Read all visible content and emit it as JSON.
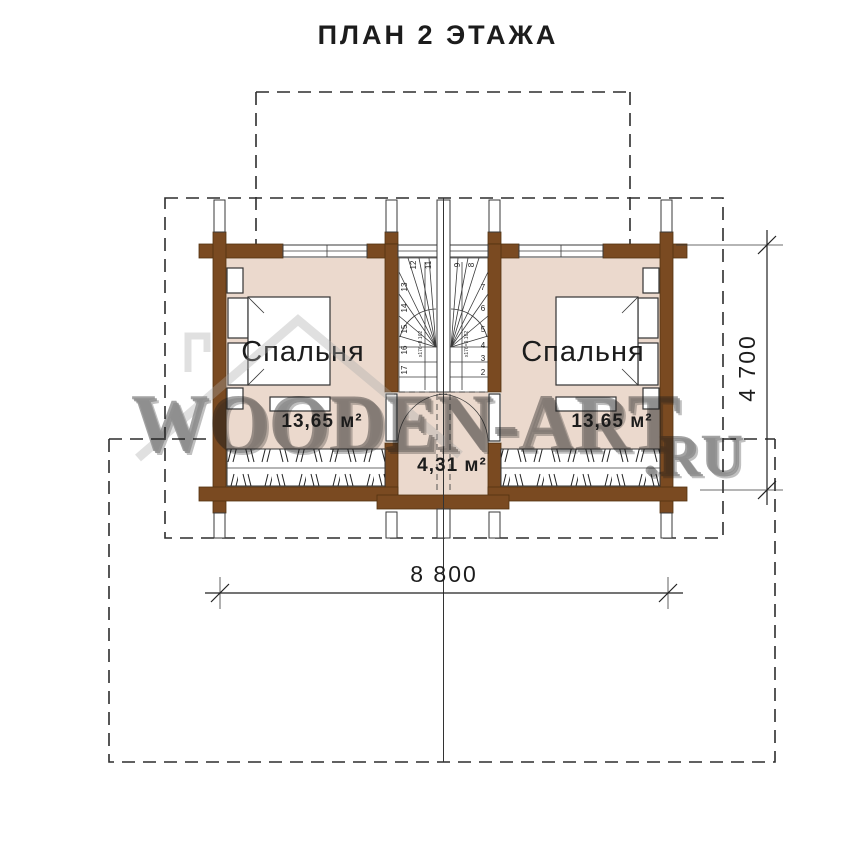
{
  "title": "ПЛАН 2 ЭТАЖА",
  "watermark": {
    "main": "WOODEN-ART",
    "suffix": ".RU"
  },
  "rooms": {
    "left_bedroom": {
      "name": "Спальня",
      "area": "13,65 м²"
    },
    "right_bedroom": {
      "name": "Спальня",
      "area": "13,65 м²"
    },
    "hall": {
      "area": "4,31 м²"
    }
  },
  "dimensions": {
    "width": "8 800",
    "depth": "4 700"
  },
  "stairs": {
    "note": "x176=9.162",
    "left": {
      "top_numbers": [
        "12",
        "11"
      ],
      "side_numbers": [
        "13",
        "14",
        "15",
        "16",
        "17"
      ]
    },
    "right": {
      "top_numbers": [
        "9",
        "8"
      ],
      "side_numbers": [
        "7",
        "6",
        "5",
        "4",
        "3",
        "2"
      ]
    }
  },
  "colors": {
    "wall_brown": "#7a4a21",
    "floor_pink": "#ebd9cd",
    "watermark_gray": "#b5b5b5"
  }
}
